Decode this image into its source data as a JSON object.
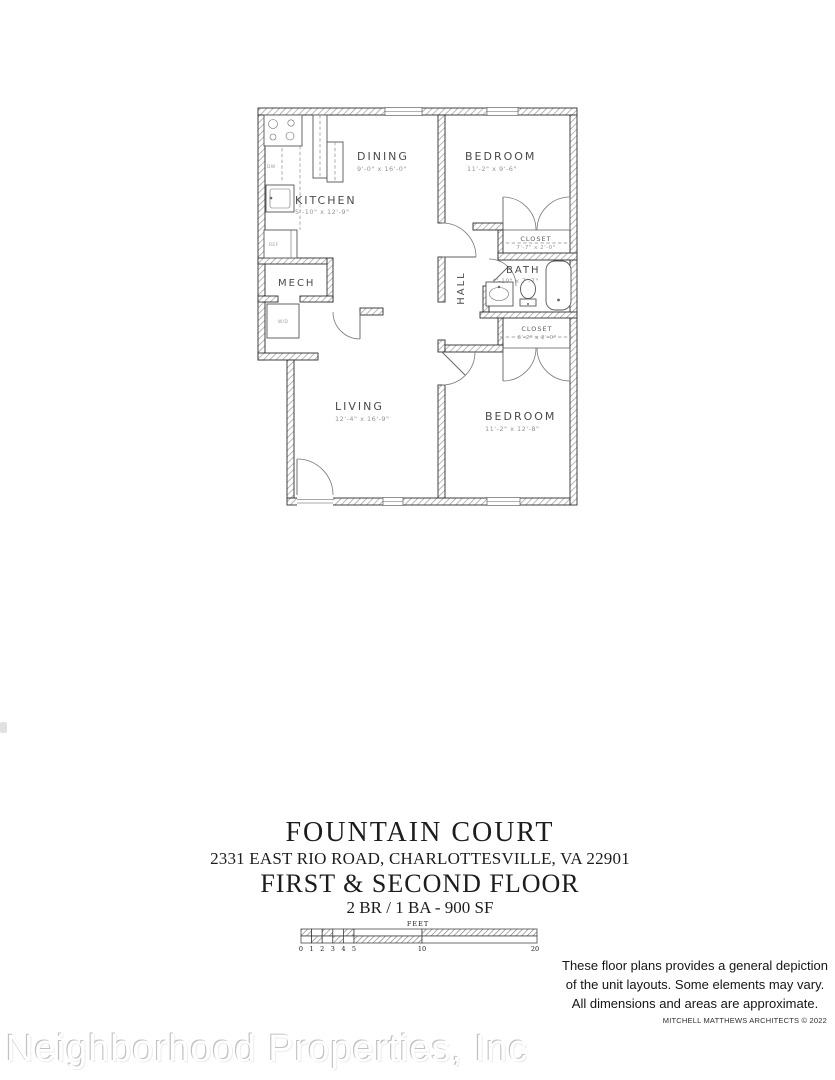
{
  "colors": {
    "ink": "#2e2e2e",
    "hatch_gray": "#9a9a9a",
    "dim_text_gray": "#949494",
    "watermark_gray": "#c2c2c2"
  },
  "floor_plan": {
    "rooms": {
      "dining": {
        "label": "DINING",
        "dims": "9'-0\" x 16'-0\""
      },
      "kitchen": {
        "label": "KITCHEN",
        "dims": "5'-10\" x 12'-9\""
      },
      "bedroom_top": {
        "label": "BEDROOM",
        "dims": "11'-2\" x 9'-6\""
      },
      "closet_top": {
        "label": "CLOSET",
        "dims": "7'-7\" x 2'-0\""
      },
      "bath": {
        "label": "BATH",
        "dims": "4'-10\" x 7'-7\""
      },
      "hall": {
        "label": "HALL"
      },
      "closet_bottom": {
        "label": "CLOSET",
        "dims": "6'-2\" x 2'-0\""
      },
      "mech": {
        "label": "MECH"
      },
      "living": {
        "label": "LIVING",
        "dims": "12'-4\" x 16'-9\""
      },
      "bedroom_bottom": {
        "label": "BEDROOM",
        "dims": "11'-2\" x 12'-8\""
      }
    },
    "fixtures": {
      "dishwasher": "DW",
      "refrigerator": "REF",
      "washer_dryer": "W/D"
    }
  },
  "title_block": {
    "property_name": "FOUNTAIN COURT",
    "address": "2331 EAST RIO ROAD, CHARLOTTESVILLE, VA 22901",
    "floor_line": "FIRST & SECOND FLOOR",
    "unit_line": "2 BR / 1 BA - 900 SF"
  },
  "scale_bar": {
    "unit_label": "FEET",
    "ticks": [
      "0",
      "1",
      "2",
      "3",
      "4",
      "5",
      "10",
      "20"
    ]
  },
  "disclaimer": {
    "line1": "These floor plans provides a general depiction",
    "line2": "of the unit layouts. Some elements may vary.",
    "line3": "All dimensions and areas are approximate.",
    "credit": "MITCHELL MATTHEWS ARCHITECTS © 2022"
  },
  "watermark": "Neighborhood Properties, Inc"
}
